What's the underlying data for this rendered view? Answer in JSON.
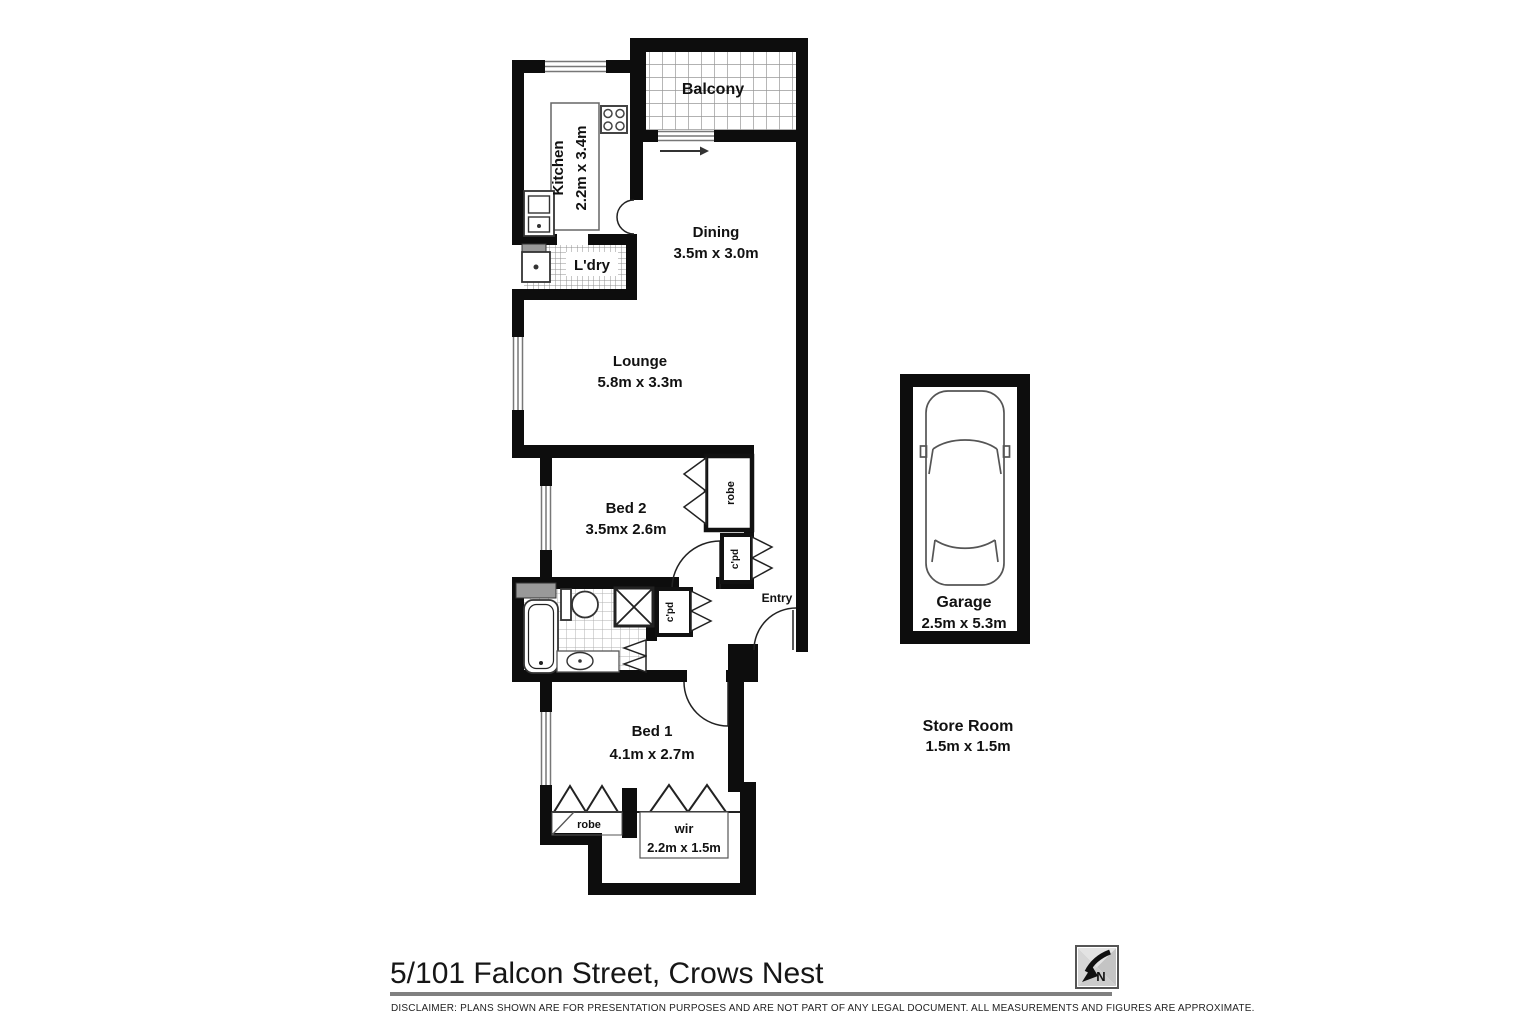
{
  "floorplan": {
    "rooms": {
      "balcony": {
        "label": "Balcony"
      },
      "kitchen": {
        "label": "Kitchen",
        "dims": "2.2m x 3.4m"
      },
      "laundry": {
        "label": "L'dry"
      },
      "dining": {
        "label": "Dining",
        "dims": "3.5m x 3.0m"
      },
      "lounge": {
        "label": "Lounge",
        "dims": "5.8m x 3.3m"
      },
      "bed2": {
        "label": "Bed 2",
        "dims": "3.5mx 2.6m"
      },
      "bed1": {
        "label": "Bed 1",
        "dims": "4.1m x 2.7m"
      },
      "entry": {
        "label": "Entry"
      },
      "robe_bed2": {
        "label": "robe"
      },
      "robe_bed1": {
        "label": "robe"
      },
      "wir": {
        "label": "wir",
        "dims": "2.2m x 1.5m"
      },
      "cpd_hall": {
        "label": "c'pd"
      },
      "cpd_bath": {
        "label": "c'pd"
      },
      "garage": {
        "label": "Garage",
        "dims": "2.5m x 5.3m"
      },
      "store_room": {
        "label": "Store Room",
        "dims": "1.5m x 1.5m"
      }
    },
    "compass_letter": "N",
    "colors": {
      "wall": "#0d0d0d",
      "tile_grout": "#999999",
      "background": "#ffffff"
    }
  },
  "footer": {
    "address": "5/101 Falcon Street, Crows Nest",
    "disclaimer": "DISCLAIMER:  PLANS SHOWN ARE FOR PRESENTATION PURPOSES AND ARE NOT PART OF ANY LEGAL DOCUMENT.  ALL MEASUREMENTS AND FIGURES ARE APPROXIMATE."
  }
}
